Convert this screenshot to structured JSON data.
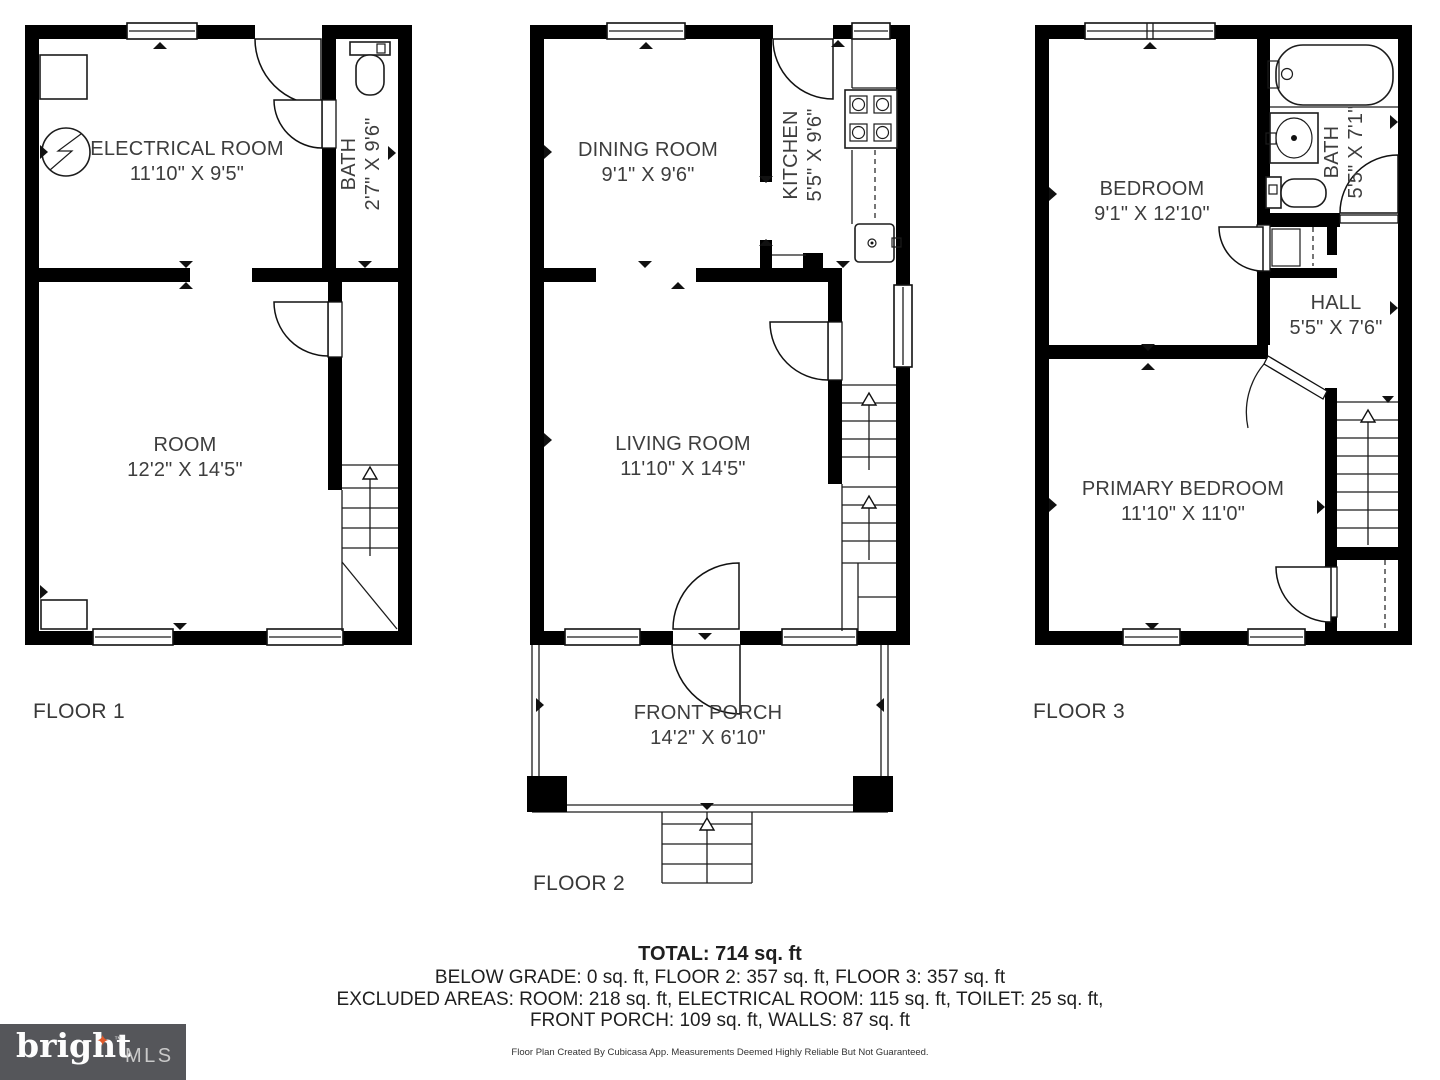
{
  "floors": [
    {
      "label": "FLOOR 1",
      "rooms": [
        {
          "name": "ELECTRICAL ROOM",
          "dims": "11'10\" X 9'5\""
        },
        {
          "name": "BATH",
          "dims": "2'7\" X 9'6\""
        },
        {
          "name": "ROOM",
          "dims": "12'2\" X 14'5\""
        }
      ]
    },
    {
      "label": "FLOOR 2",
      "rooms": [
        {
          "name": "DINING ROOM",
          "dims": "9'1\" X 9'6\""
        },
        {
          "name": "KITCHEN",
          "dims": "5'5\" X 9'6\""
        },
        {
          "name": "LIVING ROOM",
          "dims": "11'10\" X 14'5\""
        },
        {
          "name": "FRONT PORCH",
          "dims": "14'2\" X 6'10\""
        }
      ]
    },
    {
      "label": "FLOOR 3",
      "rooms": [
        {
          "name": "BEDROOM",
          "dims": "9'1\" X 12'10\""
        },
        {
          "name": "BATH",
          "dims": "5'5\" X 7'1\""
        },
        {
          "name": "HALL",
          "dims": "5'5\" X 7'6\""
        },
        {
          "name": "PRIMARY BEDROOM",
          "dims": "11'10\" X 11'0\""
        }
      ]
    }
  ],
  "summary": {
    "total": "TOTAL: 714 sq. ft",
    "line2": "BELOW GRADE: 0 sq. ft, FLOOR 2: 357 sq. ft, FLOOR 3: 357 sq. ft",
    "line3": "EXCLUDED AREAS: ROOM: 218 sq. ft, ELECTRICAL ROOM: 115 sq. ft, TOILET: 25 sq. ft,",
    "line4": "FRONT PORCH: 109 sq. ft, WALLS: 87 sq. ft",
    "disclaimer": "Floor Plan Created By Cubicasa App. Measurements Deemed Highly Reliable But Not Guaranteed."
  },
  "logo": {
    "brand": "bright",
    "star": "✦",
    "tm": "™",
    "suffix": "MLS"
  },
  "icons": [
    "electrical-symbol",
    "toilet-fixture",
    "bathtub-fixture",
    "sink-fixture",
    "stove-fixture",
    "staircase",
    "door-swing",
    "window"
  ],
  "colors": {
    "wall": "#000000",
    "text": "#3d3d3d",
    "logo_bg": "#55565a",
    "logo_star": "#e05a2b",
    "logo_mls": "#c9c9c9"
  }
}
